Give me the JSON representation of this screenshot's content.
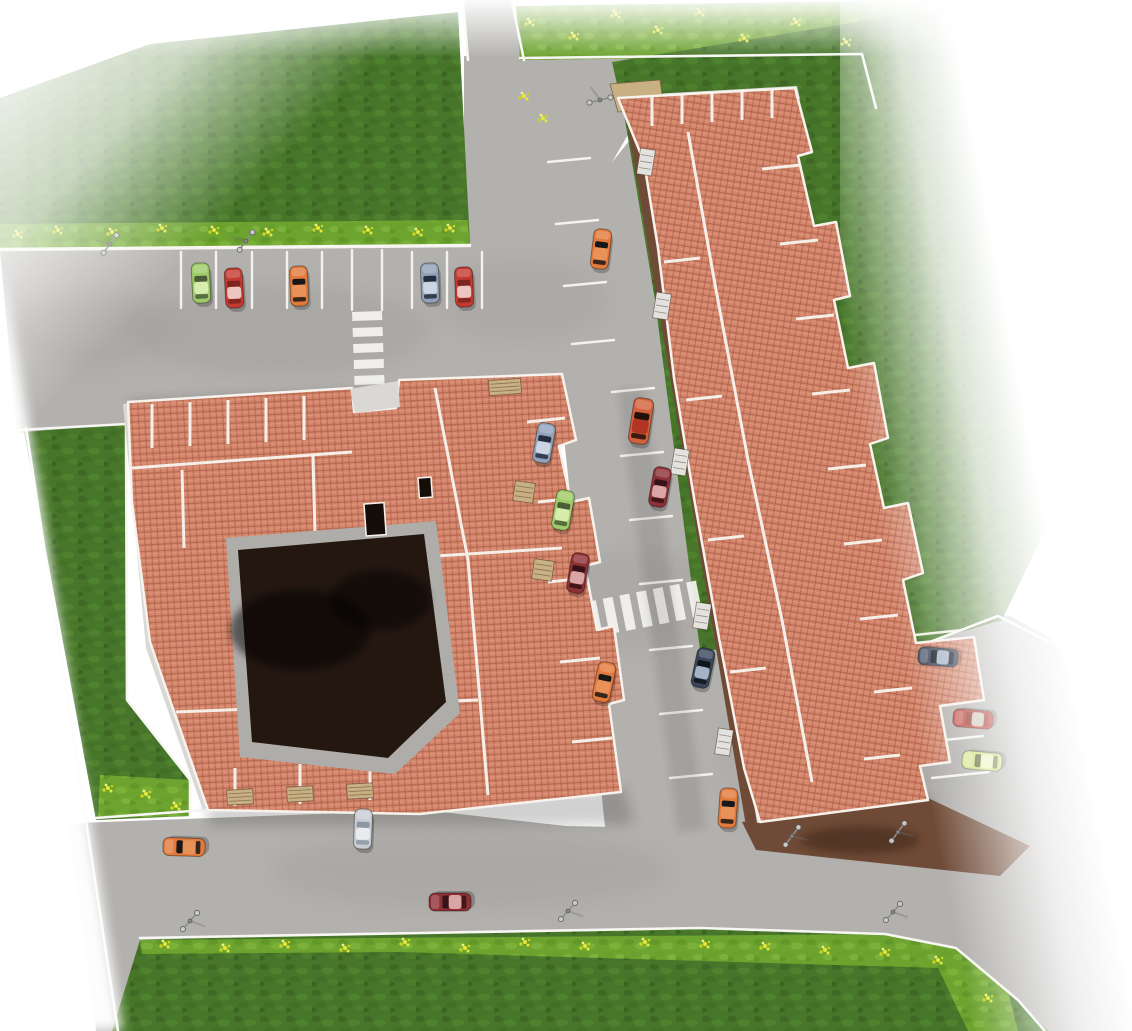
{
  "palette": {
    "page_bg": "#ffffff",
    "road": "#b3b1ae",
    "road_dark": "#a09e9c",
    "curb": "#f7f6f2",
    "grass_dark": "#47762a",
    "grass_light": "#6da32f",
    "flower_yellow": "#e0e43a",
    "roof_tile": "#d5886e",
    "roof_joint": "#a85a42",
    "roof_ridge": "#f7f3ec",
    "wall_light": "#d9d8d5",
    "wall_shadow": "#aeadaa",
    "sidewalk_brown": "#6f4b37",
    "courtyard_dark": "#241710",
    "canopy_tan": "#c8b083"
  },
  "scene": {
    "building_count": 2,
    "car_count": 20,
    "lamp_count": 8,
    "crosswalk_count": 2
  },
  "car_colors": {
    "green": {
      "body": "#9ecb67",
      "roof": "#d8ecad",
      "win": "#4c5c38"
    },
    "red": {
      "body": "#c23a31",
      "roof": "#ecc6c0",
      "win": "#7e241f"
    },
    "orange": {
      "body": "#e27a3b",
      "roof": "#e89158",
      "win": "#17171a"
    },
    "bluegray": {
      "body": "#91a1b8",
      "roof": "#ccd6e3",
      "win": "#242e3e"
    },
    "darkred": {
      "body": "#8e3036",
      "roof": "#d8a7a5",
      "win": "#351318"
    },
    "navy": {
      "body": "#3a4559",
      "roof": "#a4b3c6",
      "win": "#10141b"
    },
    "rust": {
      "body": "#d2603a",
      "roof": "#b03524",
      "win": "#221009"
    },
    "silver": {
      "body": "#c9cdd3",
      "roof": "#e9ebee",
      "win": "#8d97a2"
    },
    "redopen": {
      "body": "#b6352c",
      "roof": "#cfc5b7",
      "win": "#8c2a22"
    },
    "limeyellow": {
      "body": "#cde07b",
      "roof": "#ecf3bb",
      "win": "#55632f"
    }
  },
  "cars": [
    {
      "x": 201,
      "y": 283,
      "rot": -3,
      "color": "green"
    },
    {
      "x": 234,
      "y": 288,
      "rot": -3,
      "color": "red"
    },
    {
      "x": 299,
      "y": 286,
      "rot": -2,
      "color": "orange"
    },
    {
      "x": 430,
      "y": 283,
      "rot": -2,
      "color": "bluegray"
    },
    {
      "x": 464,
      "y": 287,
      "rot": -2,
      "color": "red"
    },
    {
      "x": 544,
      "y": 443,
      "rot": 10,
      "color": "bluegray"
    },
    {
      "x": 563,
      "y": 510,
      "rot": 10,
      "color": "green"
    },
    {
      "x": 578,
      "y": 573,
      "rot": 10,
      "color": "darkred"
    },
    {
      "x": 604,
      "y": 682,
      "rot": 12,
      "color": "orange"
    },
    {
      "x": 641,
      "y": 421,
      "rot": 9,
      "color": "rust",
      "len": 46,
      "wid": 20
    },
    {
      "x": 660,
      "y": 487,
      "rot": 10,
      "color": "darkred"
    },
    {
      "x": 703,
      "y": 668,
      "rot": 12,
      "color": "navy"
    },
    {
      "x": 601,
      "y": 249,
      "rot": 7,
      "color": "orange"
    },
    {
      "x": 938,
      "y": 657,
      "rot": -85,
      "color": "navy"
    },
    {
      "x": 973,
      "y": 719,
      "rot": -85,
      "color": "redopen"
    },
    {
      "x": 982,
      "y": 761,
      "rot": -85,
      "color": "limeyellow"
    },
    {
      "x": 728,
      "y": 808,
      "rot": 4,
      "color": "orange"
    },
    {
      "x": 184,
      "y": 847,
      "rot": -88,
      "color": "orange",
      "len": 42
    },
    {
      "x": 363,
      "y": 829,
      "rot": 2,
      "color": "silver"
    },
    {
      "x": 450,
      "y": 902,
      "rot": -90,
      "color": "darkred",
      "len": 42
    }
  ],
  "lamps": [
    [
      110,
      244,
      160
    ],
    [
      246,
      241,
      160
    ],
    [
      600,
      100,
      200
    ],
    [
      190,
      921,
      -15
    ],
    [
      568,
      911,
      -15
    ],
    [
      893,
      912,
      -15
    ],
    [
      792,
      836,
      -20
    ],
    [
      898,
      832,
      -20
    ]
  ],
  "crosswalks": [
    {
      "x": 352,
      "y": 312,
      "rot": -2,
      "dir": "h",
      "bars": 5,
      "bar_w": 30,
      "bar_h": 9,
      "gap": 7
    },
    {
      "x": 586,
      "y": 602,
      "rot": -11,
      "dir": "v",
      "bars": 7,
      "bar_w": 10,
      "bar_h": 36,
      "gap": 7
    }
  ],
  "parking_lines": [
    [
      0,
      250,
      470,
      246
    ],
    [
      181,
      252,
      181,
      308
    ],
    [
      216,
      252,
      216,
      308
    ],
    [
      252,
      252,
      252,
      308
    ],
    [
      287,
      252,
      287,
      308
    ],
    [
      322,
      252,
      322,
      308
    ],
    [
      352,
      250,
      352,
      310
    ],
    [
      382,
      250,
      382,
      310
    ],
    [
      412,
      252,
      412,
      308
    ],
    [
      447,
      252,
      447,
      308
    ],
    [
      482,
      252,
      482,
      308
    ],
    [
      548,
      162,
      590,
      158
    ],
    [
      556,
      224,
      598,
      220
    ],
    [
      564,
      286,
      606,
      282
    ],
    [
      572,
      344,
      614,
      340
    ],
    [
      498,
      410,
      540,
      406
    ],
    [
      506,
      474,
      548,
      470
    ],
    [
      514,
      540,
      556,
      536
    ],
    [
      524,
      606,
      566,
      602
    ],
    [
      536,
      672,
      578,
      668
    ],
    [
      548,
      738,
      590,
      734
    ],
    [
      612,
      392,
      654,
      388
    ],
    [
      621,
      456,
      663,
      452
    ],
    [
      630,
      520,
      672,
      516
    ],
    [
      640,
      584,
      682,
      580
    ],
    [
      650,
      650,
      692,
      646
    ],
    [
      660,
      714,
      702,
      710
    ],
    [
      670,
      778,
      712,
      774
    ],
    [
      906,
      636,
      962,
      630
    ],
    [
      912,
      671,
      969,
      665
    ],
    [
      918,
      706,
      976,
      700
    ],
    [
      925,
      742,
      983,
      736
    ],
    [
      932,
      778,
      989,
      772
    ]
  ],
  "canopies": [
    {
      "x": 505,
      "y": 387,
      "w": 32,
      "h": 15,
      "rot": -4,
      "kind": "tan"
    },
    {
      "x": 524,
      "y": 492,
      "w": 20,
      "h": 20,
      "rot": 8,
      "kind": "tan"
    },
    {
      "x": 543,
      "y": 570,
      "w": 20,
      "h": 20,
      "rot": 8,
      "kind": "tan"
    },
    {
      "x": 240,
      "y": 797,
      "w": 26,
      "h": 15,
      "rot": -3,
      "kind": "tan"
    },
    {
      "x": 300,
      "y": 794,
      "w": 26,
      "h": 15,
      "rot": -3,
      "kind": "tan"
    },
    {
      "x": 360,
      "y": 791,
      "w": 26,
      "h": 15,
      "rot": -3,
      "kind": "tan"
    },
    {
      "x": 646,
      "y": 162,
      "w": 15,
      "h": 26,
      "rot": 9,
      "kind": "gray"
    },
    {
      "x": 662,
      "y": 306,
      "w": 15,
      "h": 26,
      "rot": 9,
      "kind": "gray"
    },
    {
      "x": 680,
      "y": 462,
      "w": 15,
      "h": 26,
      "rot": 9,
      "kind": "gray"
    },
    {
      "x": 702,
      "y": 616,
      "w": 15,
      "h": 26,
      "rot": 9,
      "kind": "gray"
    },
    {
      "x": 724,
      "y": 742,
      "w": 15,
      "h": 26,
      "rot": 9,
      "kind": "gray"
    }
  ],
  "roof_hatches": [
    {
      "x": 364,
      "y": 504,
      "w": 20,
      "h": 32,
      "rot": -4
    },
    {
      "x": 418,
      "y": 478,
      "w": 13,
      "h": 20,
      "rot": -4
    }
  ],
  "flowers": [
    [
      18,
      234
    ],
    [
      58,
      230
    ],
    [
      112,
      232
    ],
    [
      162,
      228
    ],
    [
      214,
      230
    ],
    [
      268,
      232
    ],
    [
      318,
      228
    ],
    [
      368,
      230
    ],
    [
      418,
      232
    ],
    [
      450,
      228
    ],
    [
      530,
      22
    ],
    [
      574,
      36
    ],
    [
      616,
      14
    ],
    [
      658,
      30
    ],
    [
      700,
      12
    ],
    [
      744,
      38
    ],
    [
      796,
      22
    ],
    [
      846,
      42
    ],
    [
      524,
      96
    ],
    [
      543,
      118
    ],
    [
      108,
      788
    ],
    [
      146,
      794
    ],
    [
      176,
      806
    ],
    [
      165,
      944
    ],
    [
      225,
      948
    ],
    [
      285,
      944
    ],
    [
      345,
      948
    ],
    [
      405,
      942
    ],
    [
      465,
      948
    ],
    [
      525,
      942
    ],
    [
      585,
      946
    ],
    [
      645,
      942
    ],
    [
      705,
      944
    ],
    [
      765,
      946
    ],
    [
      825,
      950
    ],
    [
      885,
      952
    ],
    [
      938,
      960
    ],
    [
      988,
      998
    ]
  ]
}
